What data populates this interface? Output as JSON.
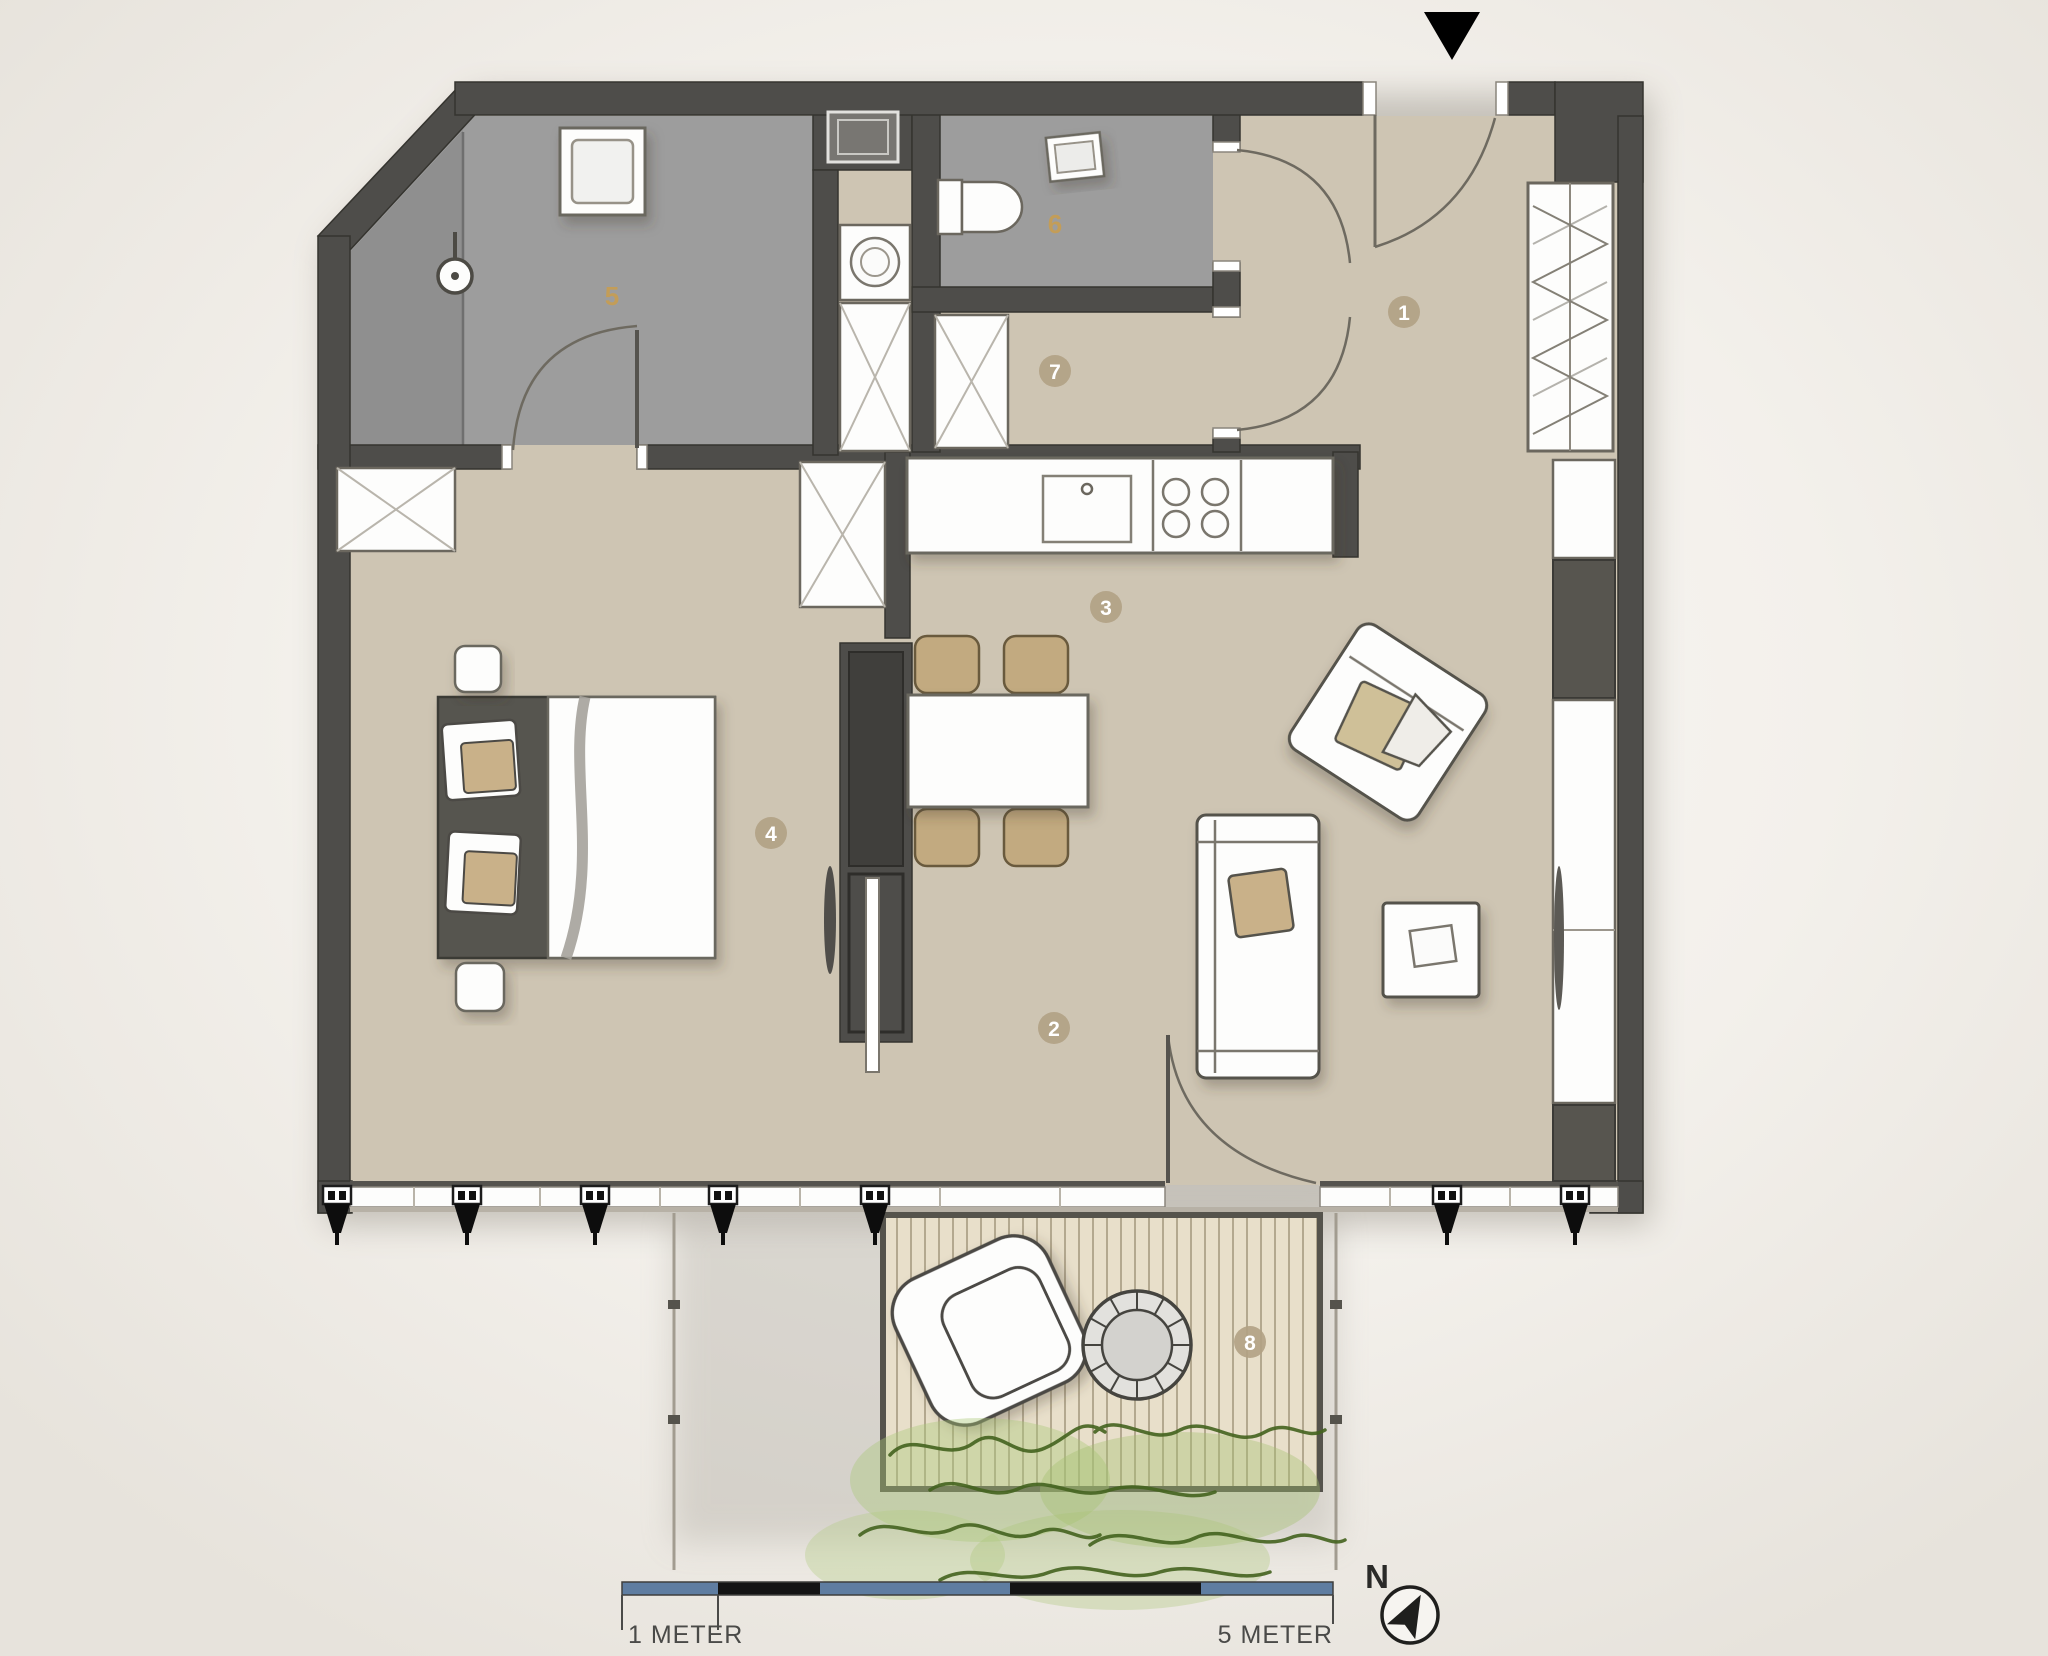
{
  "plan": {
    "type": "apartment-floor-plan",
    "rooms": [
      {
        "number": "1",
        "marker": "badge"
      },
      {
        "number": "2",
        "marker": "badge"
      },
      {
        "number": "3",
        "marker": "badge"
      },
      {
        "number": "4",
        "marker": "badge"
      },
      {
        "number": "5",
        "marker": "gold-text"
      },
      {
        "number": "6",
        "marker": "gold-text"
      },
      {
        "number": "7",
        "marker": "badge"
      },
      {
        "number": "8",
        "marker": "badge"
      }
    ],
    "scale_bar": {
      "start_label": "1 METER",
      "end_label": "5 METER"
    },
    "compass": {
      "north_label": "N"
    },
    "markers": {
      "entrance_icon": "down-triangle"
    },
    "icons": [
      "shower-icon",
      "toilet-icon",
      "washbasin-icon",
      "washing-machine-icon",
      "hob-icon",
      "sink-icon",
      "wardrobe-cross-icon",
      "hanging-rail-icon",
      "bed-icon",
      "sofa-icon",
      "armchair-icon",
      "dining-set-icon",
      "lounge-chair-icon",
      "round-table-icon",
      "spotlight-icon",
      "plant-icon",
      "north-compass-icon"
    ],
    "colors": {
      "wall": "#4e4d4a",
      "floor": "#cec5b3",
      "wet_room_floor": "#9d9d9d",
      "shower_floor": "#8f8f8f",
      "badge": "#b1a184",
      "badge_number": "#ffffff",
      "room_number_gold": "#c69e55",
      "scale_blue": "#5f7da1",
      "scale_black": "#141414",
      "deck": "#e8dfca",
      "deck_line": "#b3a88f",
      "plant_green": "#44631f",
      "furniture_tan": "#c2aa80",
      "furniture_white": "#fdfdfc"
    }
  }
}
